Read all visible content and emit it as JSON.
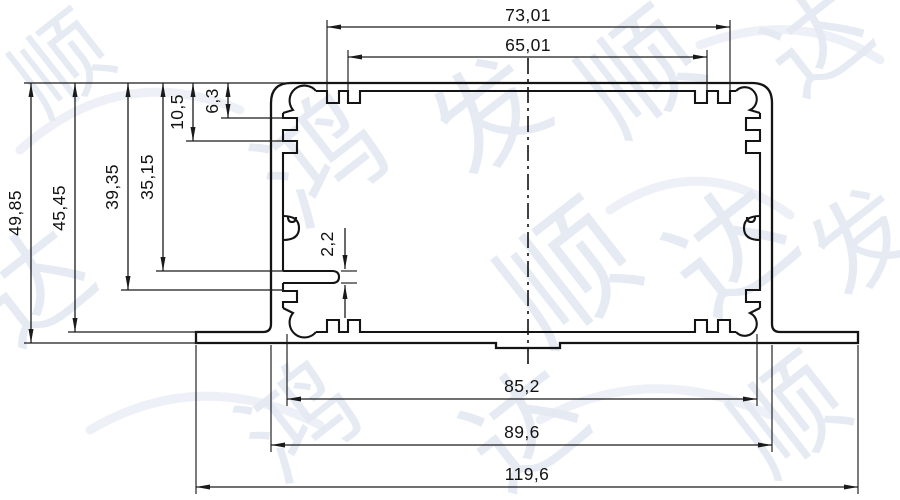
{
  "drawing": {
    "colors": {
      "line": "#141414",
      "background": "#ffffff",
      "watermark": "#e4e9f2"
    },
    "dimensions": {
      "top_width_outer": "73,01",
      "top_width_inner": "65,01",
      "height_total": "49,85",
      "height_flange": "45,45",
      "height_lower_rib": "39,35",
      "height_rail": "35,15",
      "rib_depth_2": "10,5",
      "rib_depth_1": "6,3",
      "rail_slot": "2,2",
      "bottom_width_inner": "85,2",
      "body_width": "89,6",
      "overall_width": "119,6"
    },
    "watermark": {
      "chars": [
        "顺",
        "达",
        "鸿",
        "发",
        "顺",
        "达",
        "顺",
        "达",
        "鸿",
        "达",
        "顺",
        "发"
      ]
    }
  }
}
